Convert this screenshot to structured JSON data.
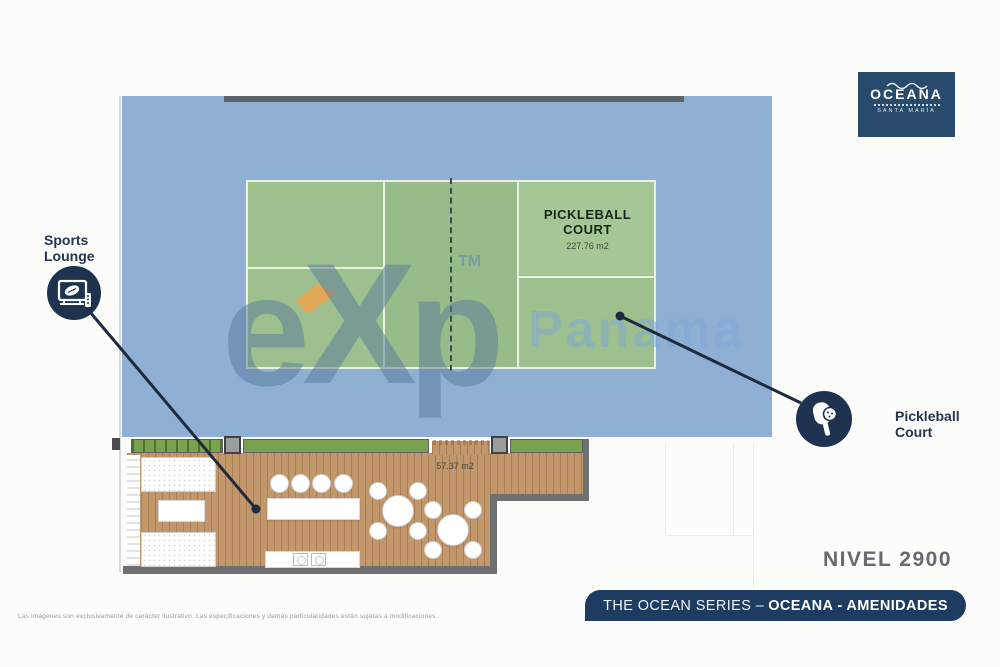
{
  "logo": {
    "name": "OCEANA",
    "location": "SANTA MARÍA"
  },
  "annotations": {
    "sports_lounge": {
      "line1": "Sports",
      "line2": "Lounge"
    },
    "pickleball": {
      "line1": "Pickleball",
      "line2": "Court"
    }
  },
  "court": {
    "name_line1": "PICKLEBALL",
    "name_line2": "COURT",
    "area": "227.76 m2"
  },
  "deck": {
    "area": "57.37 m2"
  },
  "level_label": "NIVEL 2900",
  "footer_banner": {
    "series": "THE OCEAN SERIES –",
    "highlight": "OCEANA - AMENIDADES"
  },
  "watermark": {
    "letter_e": "e",
    "letter_x": "X",
    "letter_p": "p",
    "tm": "TM",
    "region": "Panama"
  },
  "disclaimer": "Las imágenes son exclusivamente de carácter ilustrativo. Las especificaciones y demás particularidades están sujetas a modificaciones.",
  "colors": {
    "navy": "#1e3350",
    "banner_navy": "#1e3c61",
    "court_blue": "#8fafd3",
    "court_green": "#9dc08e",
    "planter_green": "#7aa24e",
    "wood": "#c2976b",
    "accent_orange": "#eda24c",
    "level_gray": "#66696d"
  }
}
